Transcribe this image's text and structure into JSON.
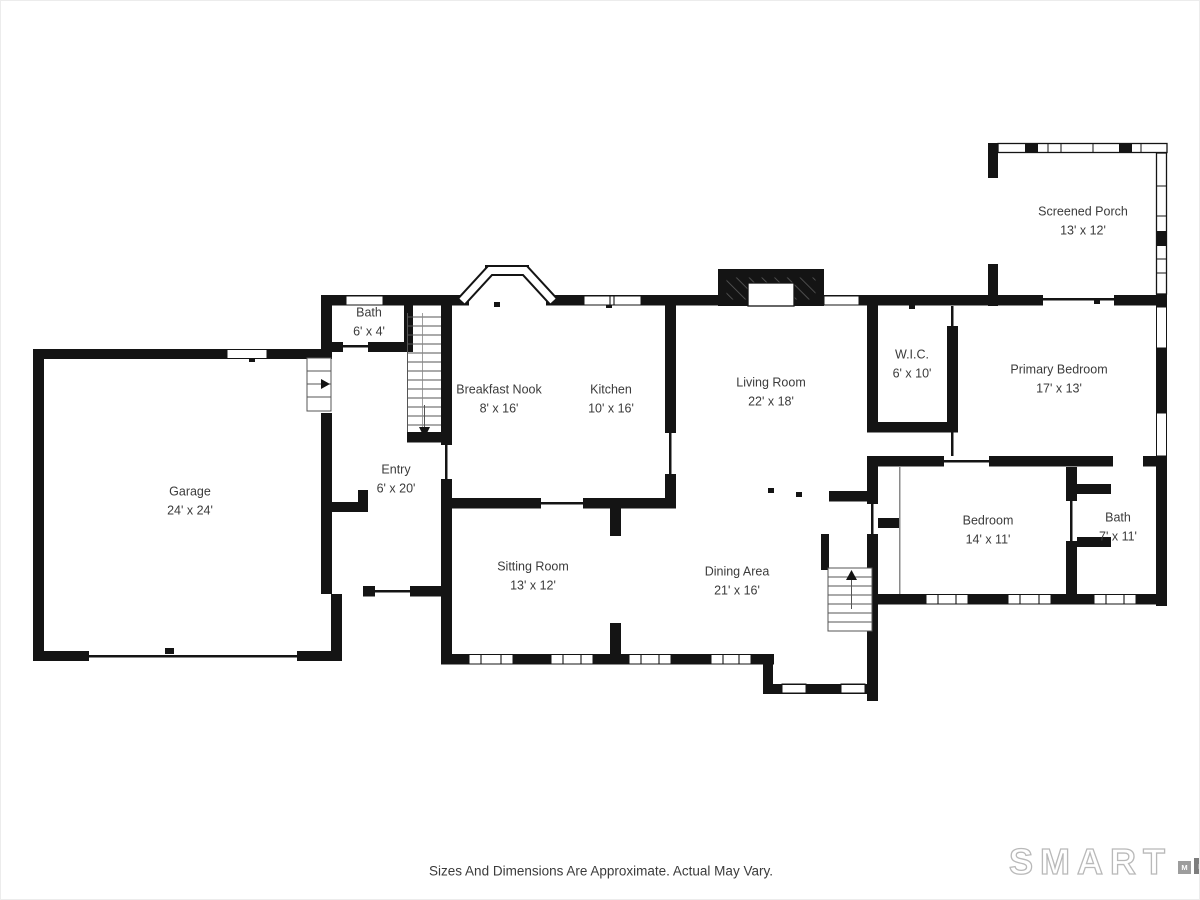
{
  "rooms": {
    "garage": {
      "name": "Garage",
      "dims": "24' x 24'"
    },
    "bath_upper": {
      "name": "Bath",
      "dims": "6' x 4'"
    },
    "entry": {
      "name": "Entry",
      "dims": "6' x 20'"
    },
    "breakfast_nook": {
      "name": "Breakfast Nook",
      "dims": "8' x 16'"
    },
    "kitchen": {
      "name": "Kitchen",
      "dims": "10' x 16'"
    },
    "living_room": {
      "name": "Living Room",
      "dims": "22' x 18'"
    },
    "wic": {
      "name": "W.I.C.",
      "dims": "6' x 10'"
    },
    "primary_bedroom": {
      "name": "Primary Bedroom",
      "dims": "17' x 13'"
    },
    "screened_porch": {
      "name": "Screened Porch",
      "dims": "13' x 12'"
    },
    "sitting_room": {
      "name": "Sitting Room",
      "dims": "13' x 12'"
    },
    "dining_area": {
      "name": "Dining Area",
      "dims": "21' x 16'"
    },
    "bedroom": {
      "name": "Bedroom",
      "dims": "14' x 11'"
    },
    "bath_lower": {
      "name": "Bath",
      "dims": "7' x 11'"
    }
  },
  "footer": {
    "disclaimer": "Sizes And Dimensions Are Approximate. Actual May Vary."
  },
  "logo": {
    "brand": "SMART",
    "letters": [
      "M",
      "L",
      "S"
    ]
  },
  "colors": {
    "wall": "#141414",
    "label": "#3b3b3b"
  }
}
